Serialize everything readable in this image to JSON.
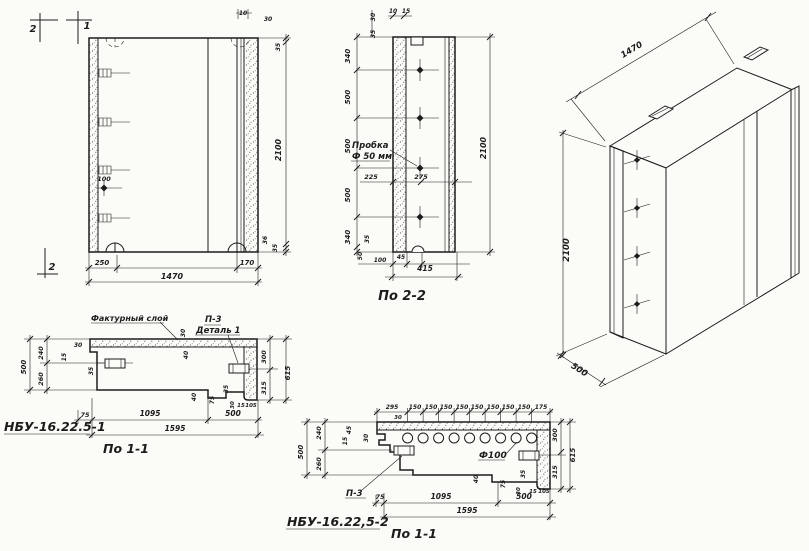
{
  "views": {
    "front": {
      "name": "front-elevation",
      "labels": [
        {
          "t": "2",
          "x": 33,
          "y": 32,
          "s": 10,
          "n": "section-mark-2-top"
        },
        {
          "t": "1",
          "x": 87,
          "y": 29,
          "s": 10,
          "n": "section-mark-1-top"
        },
        {
          "t": "2",
          "x": 52,
          "y": 270,
          "s": 10,
          "n": "section-mark-2-bottom"
        },
        {
          "t": "10",
          "x": 243,
          "y": 15,
          "s": 6
        },
        {
          "t": "30",
          "x": 268,
          "y": 21,
          "s": 6
        },
        {
          "t": "35",
          "x": 280,
          "y": 47,
          "r": -90,
          "s": 6
        },
        {
          "t": "2100",
          "x": 281,
          "y": 150,
          "r": -90,
          "s": 8
        },
        {
          "t": "36",
          "x": 267,
          "y": 240,
          "r": -90,
          "s": 6
        },
        {
          "t": "35",
          "x": 277,
          "y": 248,
          "r": -90,
          "s": 6
        },
        {
          "t": "100",
          "x": 104,
          "y": 181,
          "s": 6.5
        },
        {
          "t": "250",
          "x": 102,
          "y": 265,
          "s": 7
        },
        {
          "t": "1470",
          "x": 172,
          "y": 279,
          "s": 8
        },
        {
          "t": "170",
          "x": 247,
          "y": 265,
          "s": 7
        }
      ]
    },
    "section22": {
      "title": "По 2-2",
      "callout": {
        "line1": "Пробка",
        "line2": "Ф 50 мм"
      },
      "labels": [
        {
          "t": "30",
          "x": 375,
          "y": 17,
          "r": -90,
          "s": 6
        },
        {
          "t": "35",
          "x": 375,
          "y": 34,
          "r": -90,
          "s": 6
        },
        {
          "t": "10",
          "x": 393,
          "y": 13,
          "s": 6
        },
        {
          "t": "15",
          "x": 406,
          "y": 13,
          "s": 6
        },
        {
          "t": "340",
          "x": 350,
          "y": 56,
          "r": -90,
          "s": 7
        },
        {
          "t": "500",
          "x": 350,
          "y": 97,
          "r": -90,
          "s": 7
        },
        {
          "t": "500",
          "x": 350,
          "y": 146,
          "r": -90,
          "s": 7
        },
        {
          "t": "500",
          "x": 350,
          "y": 195,
          "r": -90,
          "s": 7
        },
        {
          "t": "340",
          "x": 350,
          "y": 237,
          "r": -90,
          "s": 7
        },
        {
          "t": "225",
          "x": 371,
          "y": 179,
          "s": 6.5
        },
        {
          "t": "275",
          "x": 421,
          "y": 179,
          "s": 6.5
        },
        {
          "t": "2100",
          "x": 486,
          "y": 148,
          "r": -90,
          "s": 8
        },
        {
          "t": "35",
          "x": 369,
          "y": 239,
          "r": -90,
          "s": 6
        },
        {
          "t": "50",
          "x": 362,
          "y": 256,
          "r": -90,
          "s": 6
        },
        {
          "t": "100",
          "x": 380,
          "y": 262,
          "s": 6
        },
        {
          "t": "45",
          "x": 401,
          "y": 259,
          "s": 6
        },
        {
          "t": "415",
          "x": 425,
          "y": 271,
          "s": 7.5
        }
      ]
    },
    "iso": {
      "name": "axonometric-view",
      "labels": [
        {
          "t": "1470",
          "x": 633,
          "y": 52,
          "r": -31,
          "s": 8.5
        },
        {
          "t": "2100",
          "x": 569,
          "y": 250,
          "r": -90,
          "s": 8.5
        },
        {
          "t": "500",
          "x": 578,
          "y": 372,
          "r": 32,
          "s": 8.5
        }
      ]
    },
    "section11a": {
      "title": "По 1-1",
      "mark": "НБУ-16.22.5-1",
      "callouts": {
        "facing": "Фактурный слой",
        "p3": "П-3",
        "detail": "Деталь 1"
      },
      "labels": [
        {
          "t": "500",
          "x": 26,
          "y": 367,
          "r": -90,
          "s": 7
        },
        {
          "t": "240",
          "x": 43,
          "y": 353,
          "r": -90,
          "s": 6.5
        },
        {
          "t": "260",
          "x": 43,
          "y": 379,
          "r": -90,
          "s": 6.5
        },
        {
          "t": "30",
          "x": 78,
          "y": 347,
          "s": 6
        },
        {
          "t": "15",
          "x": 66,
          "y": 357,
          "r": -90,
          "s": 6
        },
        {
          "t": "35",
          "x": 93,
          "y": 371,
          "r": -90,
          "s": 6
        },
        {
          "t": "30",
          "x": 185,
          "y": 333,
          "r": -90,
          "s": 6
        },
        {
          "t": "40",
          "x": 188,
          "y": 355,
          "r": -90,
          "s": 6
        },
        {
          "t": "300",
          "x": 266,
          "y": 357,
          "r": -90,
          "s": 6.5
        },
        {
          "t": "315",
          "x": 266,
          "y": 388,
          "r": -90,
          "s": 6.5
        },
        {
          "t": "615",
          "x": 290,
          "y": 373,
          "r": -90,
          "s": 7
        },
        {
          "t": "75",
          "x": 85,
          "y": 417,
          "s": 6.5
        },
        {
          "t": "1095",
          "x": 150,
          "y": 416,
          "s": 7.5
        },
        {
          "t": "500",
          "x": 233,
          "y": 416,
          "s": 7.5
        },
        {
          "t": "1595",
          "x": 175,
          "y": 431,
          "s": 7.5
        },
        {
          "t": "40",
          "x": 196,
          "y": 397,
          "r": -90,
          "s": 6
        },
        {
          "t": "75",
          "x": 214,
          "y": 400,
          "r": -90,
          "s": 6
        },
        {
          "t": "35",
          "x": 228,
          "y": 389,
          "r": -90,
          "s": 6
        },
        {
          "t": "30",
          "x": 234,
          "y": 405,
          "r": -90,
          "s": 5.5
        },
        {
          "t": "15",
          "x": 241,
          "y": 407,
          "s": 5.5
        },
        {
          "t": "105",
          "x": 251,
          "y": 407,
          "s": 5.5
        }
      ]
    },
    "section11b": {
      "title": "По 1-1",
      "mark": "НБУ-16.22,5-2",
      "callouts": {
        "p3": "П-3",
        "hole": "Ф100"
      },
      "labels": [
        {
          "t": "295",
          "x": 392,
          "y": 409,
          "s": 6
        },
        {
          "t": "150",
          "x": 415,
          "y": 409,
          "s": 6
        },
        {
          "t": "150",
          "x": 431,
          "y": 409,
          "s": 6
        },
        {
          "t": "150",
          "x": 446,
          "y": 409,
          "s": 6
        },
        {
          "t": "150",
          "x": 462,
          "y": 409,
          "s": 6
        },
        {
          "t": "150",
          "x": 477,
          "y": 409,
          "s": 6
        },
        {
          "t": "150",
          "x": 493,
          "y": 409,
          "s": 6
        },
        {
          "t": "150",
          "x": 508,
          "y": 409,
          "s": 6
        },
        {
          "t": "150",
          "x": 524,
          "y": 409,
          "s": 6
        },
        {
          "t": "175",
          "x": 541,
          "y": 409,
          "s": 6
        },
        {
          "t": "30",
          "x": 398,
          "y": 419,
          "s": 5.5
        },
        {
          "t": "500",
          "x": 303,
          "y": 452,
          "r": -90,
          "s": 7
        },
        {
          "t": "240",
          "x": 321,
          "y": 433,
          "r": -90,
          "s": 6.5
        },
        {
          "t": "260",
          "x": 321,
          "y": 464,
          "r": -90,
          "s": 6.5
        },
        {
          "t": "45",
          "x": 351,
          "y": 430,
          "r": -90,
          "s": 6
        },
        {
          "t": "15",
          "x": 347,
          "y": 441,
          "r": -90,
          "s": 6
        },
        {
          "t": "30",
          "x": 368,
          "y": 438,
          "r": -90,
          "s": 6
        },
        {
          "t": "300",
          "x": 557,
          "y": 435,
          "r": -90,
          "s": 6.5
        },
        {
          "t": "315",
          "x": 557,
          "y": 472,
          "r": -90,
          "s": 6.5
        },
        {
          "t": "615",
          "x": 575,
          "y": 455,
          "r": -90,
          "s": 7
        },
        {
          "t": "75",
          "x": 380,
          "y": 499,
          "s": 6.5
        },
        {
          "t": "1095",
          "x": 441,
          "y": 499,
          "s": 7.5
        },
        {
          "t": "500",
          "x": 524,
          "y": 499,
          "s": 7.5
        },
        {
          "t": "1595",
          "x": 467,
          "y": 513,
          "s": 7.5
        },
        {
          "t": "40",
          "x": 478,
          "y": 479,
          "r": -90,
          "s": 6
        },
        {
          "t": "75",
          "x": 505,
          "y": 484,
          "r": -90,
          "s": 6
        },
        {
          "t": "35",
          "x": 525,
          "y": 474,
          "r": -90,
          "s": 6
        },
        {
          "t": "30",
          "x": 520,
          "y": 491,
          "r": -90,
          "s": 5.5
        },
        {
          "t": "15",
          "x": 533,
          "y": 493,
          "s": 5.5
        },
        {
          "t": "105",
          "x": 544,
          "y": 493,
          "s": 5.5
        }
      ]
    }
  }
}
